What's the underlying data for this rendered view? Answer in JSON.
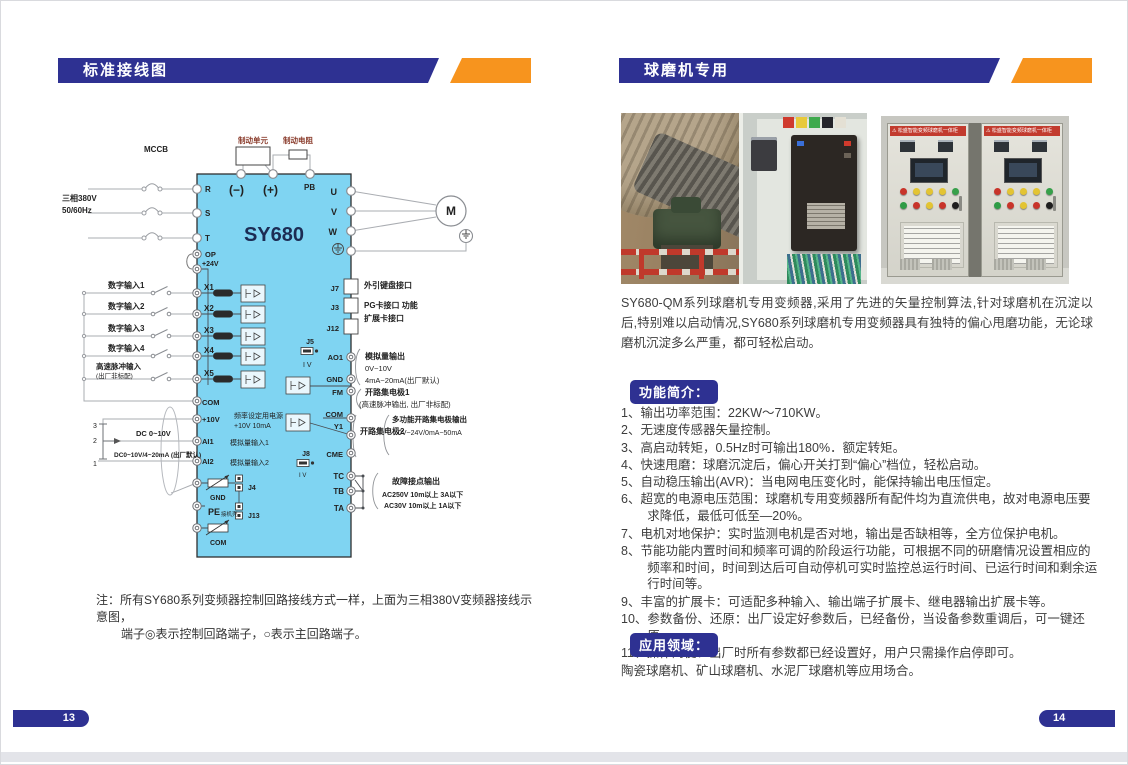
{
  "colors": {
    "navy": "#2e3192",
    "orange": "#f7941e",
    "panel_cyan": "#7fd4f2",
    "banner_red": "#c23b2e"
  },
  "left_page": {
    "header": "标准接线图",
    "page_number": "13",
    "note_label": "注：",
    "note_line1": "所有SY680系列变频器控制回路接线方式一样，上面为三相380V变频器接线示意图，",
    "note_line2": "端子◎表示控制回路端子，○表示主回路端子。",
    "diagram": {
      "model": "SY680",
      "brake_unit": "制动单元",
      "brake_resistor": "制动电阻",
      "minus": "(−)",
      "plus": "(+)",
      "pb": "PB",
      "mccb": "MCCB",
      "supply1": "三相380V",
      "supply2": "50/60Hz",
      "r": "R",
      "s": "S",
      "t": "T",
      "op": "OP",
      "p24": "+24V",
      "x1": "X1",
      "x2": "X2",
      "x3": "X3",
      "x4": "X4",
      "x5": "X5",
      "di1": "数字输入1",
      "di2": "数字输入2",
      "di3": "数字输入3",
      "di4": "数字输入4",
      "pulse1": "高速脉冲输入",
      "pulse2": "(出厂非标配)",
      "com": "COM",
      "p10": "+10V",
      "freq1": "频率设定用电源",
      "freq2": "+10V 10mA",
      "ai1": "AI1",
      "ai1_label": "模拟量输入1",
      "ai2": "AI2",
      "ai2_label": "模拟量输入2",
      "dc1": "DC 0~10V",
      "dc2": "DC0~10V/4~20mA (出厂默认)",
      "pot3": "3",
      "pot2": "2",
      "pot1": "1",
      "gnd": "GND",
      "j4": "J4",
      "pe": "PE",
      "pe_sub": "接机壳",
      "j13": "J13",
      "u": "U",
      "v": "V",
      "w": "W",
      "m": "M",
      "j7": "J7",
      "j7_label": "外引键盘接口",
      "j3": "J3",
      "j3_label": "PG卡接口 功能",
      "j12": "J12",
      "j12_label": "扩展卡接口",
      "j5": "J5",
      "iv": "I V",
      "ao1": "AO1",
      "aout1": "模拟量输出",
      "aout2": "0V~10V",
      "aout3": "4mA~20mA(出厂默认)",
      "fm": "FM",
      "oc1a": "开路集电极1",
      "oc1b": "(高速脉冲输出, 出厂非标配)",
      "y1": "Y1",
      "cme": "CME",
      "oc2": "开路集电极2",
      "moc1": "多功能开路集电极输出",
      "moc2": "0V~24V/0mA~50mA",
      "j8": "J8",
      "tc": "TC",
      "tb": "TB",
      "ta": "TA",
      "fault1": "故障接点输出",
      "fault2": "AC250V 10m以上 3A以下",
      "fault3": "AC30V 10m以上 1A以下"
    }
  },
  "right_page": {
    "header": "球磨机专用",
    "page_number": "14",
    "cabinet_banner": "⚠ 松盛智能变频球磨机一体柜",
    "intro": "SY680-QM系列球磨机专用变频器,采用了先进的矢量控制算法,针对球磨机在沉淀以后,特别难以启动情况,SY680系列球磨机专用变频器具有独特的偏心甩磨功能，无论球磨机沉淀多么严重，都可轻松启动。",
    "features_title": "功能简介：",
    "features": [
      "1、输出功率范围：22KW～710KW。",
      "2、无速度传感器矢量控制。",
      "3、高启动转矩，0.5Hz时可输出180%．额定转矩。",
      "4、快速甩磨：球磨沉淀后，偏心开关打到“偏心”档位，轻松启动。",
      "5、自动稳压输出(AVR)：当电网电压变化时，能保持输出电压恒定。",
      "6、超宽的电源电压范围：球磨机专用变频器所有配件均为直流供电，故对电源电压要求降低，最低可低至—20%。",
      "7、电机对地保护：实时监测电机是否对地，输出是否缺相等，全方位保护电机。",
      "8、节能功能内置时间和频率可调的阶段运行功能，可根据不同的研磨情况设置相应的频率和时间，时间到达后可自动停机可实时监控总运行时间、已运行时间和剩余运行时间等。",
      "9、丰富的扩展卡：可适配多种输入、输出端子扩展卡、继电器输出扩展卡等。",
      "10、参数备份、还原：出厂设定好参数后，已经备份，当设备参数重调后，可一键还原。",
      "11、操作简便：出厂时所有参数都已经设置好，用户只需操作启停即可。"
    ],
    "application_title": "应用领域：",
    "application_text": "陶瓷球磨机、矿山球磨机、水泥厂球磨机等应用场合。"
  }
}
